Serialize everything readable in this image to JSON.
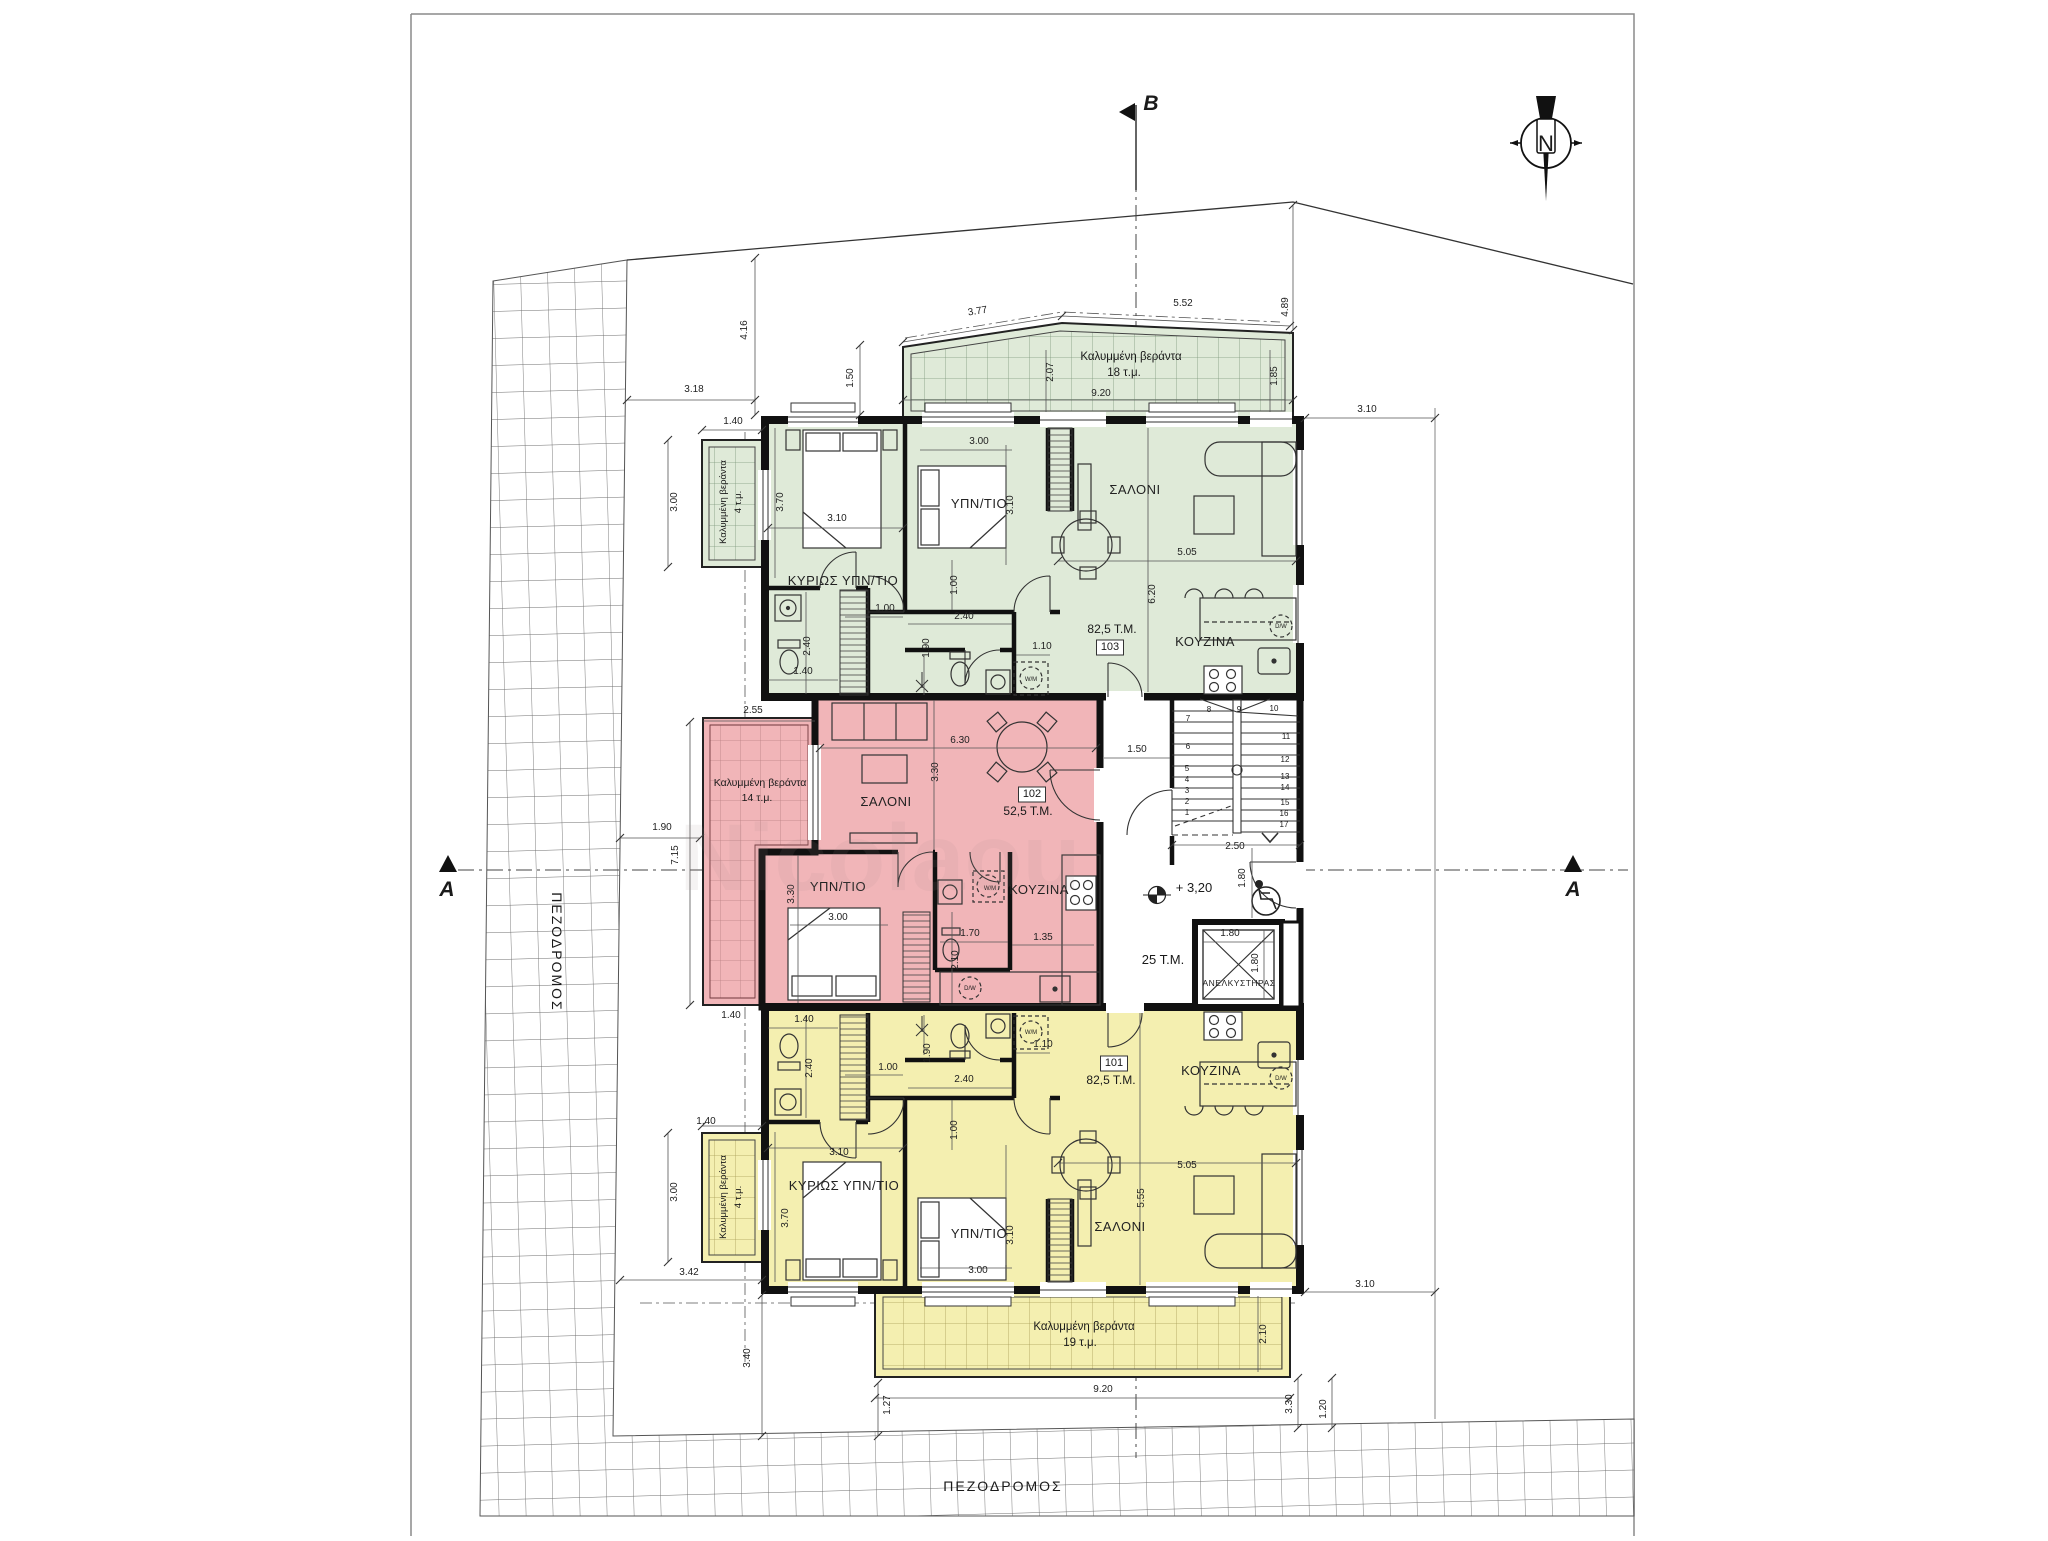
{
  "site": {
    "street_left": "ΠΕΖΟΔΡΟΜΟΣ",
    "street_bottom": "ΠΕΖΟΔΡΟΜΟΣ",
    "section_markers": [
      "A",
      "A",
      "B"
    ],
    "north_label": "N",
    "common_hall_area": "25 T.M.",
    "elevator_label": "ΑΝΕΛΚΥΣΤΗΡΑΣ",
    "level_mark": "+ 3,20",
    "stair_step_count": 17
  },
  "units": [
    {
      "id": "103",
      "area": "82,5 T.M.",
      "fill": "#dfead8",
      "rooms": [
        "ΚΥΡΙΩΣ ΥΠΝ/ΤΙΟ",
        "ΥΠΝ/ΤΙΟ",
        "ΣΑΛΟΝΙ",
        "ΚΟΥΖΙΝΑ"
      ],
      "verandas": [
        "Καλυμμένη βεράντα 18 τ.μ.",
        "Καλυμμένη βεράντα 4 τ.μ."
      ]
    },
    {
      "id": "102",
      "area": "52,5 T.M.",
      "fill": "#f1b5b8",
      "rooms": [
        "ΣΑΛΟΝΙ",
        "ΥΠΝ/ΤΙΟ",
        "ΚΟΥΖΙΝΑ"
      ],
      "verandas": [
        "Καλυμμένη βεράντα 14 τ.μ."
      ]
    },
    {
      "id": "101",
      "area": "82,5 T.M.",
      "fill": "#f4efb0",
      "rooms": [
        "ΚΥΡΙΩΣ ΥΠΝ/ΤΙΟ",
        "ΥΠΝ/ΤΙΟ",
        "ΣΑΛΟΝΙ",
        "ΚΟΥΖΙΝΑ"
      ],
      "verandas": [
        "Καλυμμένη βεράντα 19 τ.μ.",
        "Καλυμμένη βεράντα 4 τ.μ."
      ]
    }
  ],
  "colors": {
    "green": "#dfead8",
    "pink": "#f1b5b8",
    "yellow": "#f4efb0",
    "wall": "#111111"
  },
  "annotations": [
    {
      "t": "B",
      "x": 1151,
      "y": 110,
      "s": 21,
      "k": "section"
    },
    {
      "t": "A",
      "x": 447,
      "y": 896,
      "s": 21,
      "k": "section"
    },
    {
      "t": "A",
      "x": 1573,
      "y": 896,
      "s": 21,
      "k": "section"
    },
    {
      "t": "N",
      "x": 1546,
      "y": 151,
      "s": 22,
      "k": "compass"
    },
    {
      "t": "ΠΕΖΟΔΡΟΜΟΣ",
      "x": 552,
      "y": 952,
      "s": 14,
      "r": 90,
      "k": "street"
    },
    {
      "t": "ΠΕΖΟΔΡΟΜΟΣ",
      "x": 1003,
      "y": 1491,
      "s": 14,
      "k": "street"
    },
    {
      "t": "ΚΥΡΙΩΣ ΥΠΝ/ΤΙΟ",
      "x": 843,
      "y": 585,
      "s": 13,
      "k": "room"
    },
    {
      "t": "ΥΠΝ/ΤΙΟ",
      "x": 979,
      "y": 508,
      "s": 13,
      "k": "room"
    },
    {
      "t": "ΣΑΛΟΝΙ",
      "x": 1135,
      "y": 494,
      "s": 13,
      "k": "room"
    },
    {
      "t": "ΚΟΥΖΙΝΑ",
      "x": 1205,
      "y": 646,
      "s": 13,
      "k": "room"
    },
    {
      "t": "82,5 T.M.",
      "x": 1112,
      "y": 633,
      "s": 12,
      "k": "area"
    },
    {
      "t": "103",
      "x": 1110,
      "y": 650,
      "s": 11,
      "k": "unit",
      "box": 1
    },
    {
      "t": "Καλυμμένη βεράντα",
      "x": 1131,
      "y": 360,
      "s": 11.5,
      "k": "ver"
    },
    {
      "t": "18 τ.μ.",
      "x": 1124,
      "y": 376,
      "s": 11.5,
      "k": "ver"
    },
    {
      "t": "Καλυμμένη βεράντα",
      "x": 726,
      "y": 502,
      "s": 9.5,
      "r": -90,
      "k": "ver"
    },
    {
      "t": "4 τ.μ.",
      "x": 741,
      "y": 502,
      "s": 9.5,
      "r": -90,
      "k": "ver"
    },
    {
      "t": "ΣΑΛΟΝΙ",
      "x": 886,
      "y": 806,
      "s": 13,
      "k": "room"
    },
    {
      "t": "ΥΠΝ/ΤΙΟ",
      "x": 838,
      "y": 891,
      "s": 13,
      "k": "room"
    },
    {
      "t": "ΚΟΥΖΙΝΑ",
      "x": 1039,
      "y": 894,
      "s": 13,
      "k": "room"
    },
    {
      "t": "102",
      "x": 1032,
      "y": 797,
      "s": 11,
      "k": "unit",
      "box": 1
    },
    {
      "t": "52,5 T.M.",
      "x": 1028,
      "y": 815,
      "s": 12,
      "k": "area"
    },
    {
      "t": "Καλυμμένη βεράντα",
      "x": 760,
      "y": 786,
      "s": 10.5,
      "k": "ver"
    },
    {
      "t": "14 τ.μ.",
      "x": 757,
      "y": 801,
      "s": 10.5,
      "k": "ver"
    },
    {
      "t": "ΚΥΡΙΩΣ ΥΠΝ/ΤΙΟ",
      "x": 844,
      "y": 1190,
      "s": 13,
      "k": "room"
    },
    {
      "t": "ΥΠΝ/ΤΙΟ",
      "x": 979,
      "y": 1238,
      "s": 13,
      "k": "room"
    },
    {
      "t": "ΣΑΛΟΝΙ",
      "x": 1120,
      "y": 1231,
      "s": 13,
      "k": "room"
    },
    {
      "t": "ΚΟΥΖΙΝΑ",
      "x": 1211,
      "y": 1075,
      "s": 13,
      "k": "room"
    },
    {
      "t": "101",
      "x": 1114,
      "y": 1066,
      "s": 11,
      "k": "unit",
      "box": 1
    },
    {
      "t": "82,5 T.M.",
      "x": 1111,
      "y": 1084,
      "s": 12,
      "k": "area"
    },
    {
      "t": "Καλυμμένη βεράντα",
      "x": 1084,
      "y": 1330,
      "s": 11.5,
      "k": "ver"
    },
    {
      "t": "19 τ.μ.",
      "x": 1080,
      "y": 1346,
      "s": 11.5,
      "k": "ver"
    },
    {
      "t": "Καλυμμένη βεράντα",
      "x": 726,
      "y": 1197,
      "s": 9.5,
      "r": -90,
      "k": "ver"
    },
    {
      "t": "4 τ.μ.",
      "x": 741,
      "y": 1197,
      "s": 9.5,
      "r": -90,
      "k": "ver"
    },
    {
      "t": "ΑΝΕΛΚΥΣΤΗΡΑΣ",
      "x": 1239,
      "y": 986,
      "s": 8.5,
      "k": "room"
    },
    {
      "t": "25 T.M.",
      "x": 1163,
      "y": 964,
      "s": 13,
      "k": "area"
    },
    {
      "t": "+ 3,20",
      "x": 1194,
      "y": 892,
      "s": 13,
      "k": "level"
    },
    {
      "t": "4.16",
      "x": 747,
      "y": 330,
      "r": -90,
      "k": "dim"
    },
    {
      "t": "3.18",
      "x": 694,
      "y": 392,
      "k": "dim"
    },
    {
      "t": "1.50",
      "x": 853,
      "y": 378,
      "r": -90,
      "k": "dim"
    },
    {
      "t": "1.40",
      "x": 733,
      "y": 424,
      "k": "dim"
    },
    {
      "t": "3.77",
      "x": 978,
      "y": 314,
      "r": -9,
      "k": "dim"
    },
    {
      "t": "5.52",
      "x": 1183,
      "y": 306,
      "k": "dim"
    },
    {
      "t": "4.89",
      "x": 1288,
      "y": 307,
      "r": -90,
      "k": "dim"
    },
    {
      "t": "2.07",
      "x": 1053,
      "y": 372,
      "r": -90,
      "k": "dim"
    },
    {
      "t": "9.20",
      "x": 1101,
      "y": 396,
      "k": "dim"
    },
    {
      "t": "1.85",
      "x": 1277,
      "y": 376,
      "r": -90,
      "k": "dim"
    },
    {
      "t": "3.10",
      "x": 1367,
      "y": 412,
      "k": "dim"
    },
    {
      "t": "3.70",
      "x": 783,
      "y": 502,
      "r": -90,
      "k": "dim"
    },
    {
      "t": "3.10",
      "x": 837,
      "y": 521,
      "k": "dim"
    },
    {
      "t": "3.00",
      "x": 979,
      "y": 444,
      "k": "dim"
    },
    {
      "t": "3.10",
      "x": 1013,
      "y": 505,
      "r": -90,
      "k": "dim"
    },
    {
      "t": "5.05",
      "x": 1187,
      "y": 555,
      "k": "dim"
    },
    {
      "t": "6.20",
      "x": 1155,
      "y": 594,
      "r": -90,
      "k": "dim"
    },
    {
      "t": "1.00",
      "x": 957,
      "y": 585,
      "r": -90,
      "k": "dim"
    },
    {
      "t": "1.00",
      "x": 885,
      "y": 611,
      "k": "dim"
    },
    {
      "t": "2.40",
      "x": 964,
      "y": 619,
      "k": "dim"
    },
    {
      "t": "1.90",
      "x": 929,
      "y": 648,
      "r": -90,
      "k": "dim"
    },
    {
      "t": "1.10",
      "x": 1042,
      "y": 649,
      "k": "dim"
    },
    {
      "t": "2.40",
      "x": 810,
      "y": 646,
      "r": -90,
      "k": "dim"
    },
    {
      "t": "1.40",
      "x": 803,
      "y": 674,
      "k": "dim"
    },
    {
      "t": "3.00",
      "x": 677,
      "y": 502,
      "r": -90,
      "k": "dim"
    },
    {
      "t": "2.55",
      "x": 753,
      "y": 713,
      "k": "dim"
    },
    {
      "t": "6.30",
      "x": 960,
      "y": 743,
      "k": "dim"
    },
    {
      "t": "3.30",
      "x": 938,
      "y": 772,
      "r": -90,
      "k": "dim"
    },
    {
      "t": "3.30",
      "x": 794,
      "y": 894,
      "r": -90,
      "k": "dim"
    },
    {
      "t": "3.00",
      "x": 838,
      "y": 920,
      "k": "dim"
    },
    {
      "t": "1.70",
      "x": 970,
      "y": 936,
      "k": "dim"
    },
    {
      "t": "2.10",
      "x": 958,
      "y": 960,
      "r": -90,
      "k": "dim"
    },
    {
      "t": "1.35",
      "x": 1043,
      "y": 940,
      "k": "dim"
    },
    {
      "t": "1.50",
      "x": 1137,
      "y": 752,
      "k": "dim"
    },
    {
      "t": "1.90",
      "x": 662,
      "y": 830,
      "k": "dim"
    },
    {
      "t": "7.15",
      "x": 678,
      "y": 855,
      "r": -90,
      "k": "dim"
    },
    {
      "t": "1.40",
      "x": 731,
      "y": 1018,
      "k": "dim"
    },
    {
      "t": "2.50",
      "x": 1235,
      "y": 849,
      "k": "dim"
    },
    {
      "t": "1.80",
      "x": 1245,
      "y": 878,
      "r": -90,
      "k": "dim"
    },
    {
      "t": "1.80",
      "x": 1230,
      "y": 936,
      "k": "dim"
    },
    {
      "t": "1.80",
      "x": 1258,
      "y": 963,
      "r": -90,
      "k": "dim"
    },
    {
      "t": "1.40",
      "x": 804,
      "y": 1022,
      "k": "dim"
    },
    {
      "t": "2.40",
      "x": 812,
      "y": 1068,
      "r": -90,
      "k": "dim"
    },
    {
      "t": "1.00",
      "x": 888,
      "y": 1070,
      "k": "dim"
    },
    {
      "t": "1.90",
      "x": 930,
      "y": 1053,
      "r": -90,
      "k": "dim"
    },
    {
      "t": "2.40",
      "x": 964,
      "y": 1082,
      "k": "dim"
    },
    {
      "t": "1.10",
      "x": 1043,
      "y": 1047,
      "k": "dim"
    },
    {
      "t": "1.00",
      "x": 957,
      "y": 1130,
      "r": -90,
      "k": "dim"
    },
    {
      "t": "3.10",
      "x": 839,
      "y": 1155,
      "k": "dim"
    },
    {
      "t": "3.70",
      "x": 788,
      "y": 1218,
      "r": -90,
      "k": "dim"
    },
    {
      "t": "3.00",
      "x": 978,
      "y": 1273,
      "k": "dim"
    },
    {
      "t": "3.10",
      "x": 1013,
      "y": 1235,
      "r": -90,
      "k": "dim"
    },
    {
      "t": "5.55",
      "x": 1144,
      "y": 1198,
      "r": -90,
      "k": "dim"
    },
    {
      "t": "5.05",
      "x": 1187,
      "y": 1168,
      "k": "dim"
    },
    {
      "t": "3.00",
      "x": 677,
      "y": 1192,
      "r": -90,
      "k": "dim"
    },
    {
      "t": "1.40",
      "x": 706,
      "y": 1124,
      "k": "dim"
    },
    {
      "t": "3.42",
      "x": 689,
      "y": 1275,
      "k": "dim"
    },
    {
      "t": "3.40",
      "x": 750,
      "y": 1358,
      "r": -90,
      "k": "dim"
    },
    {
      "t": "2.10",
      "x": 1266,
      "y": 1334,
      "r": -90,
      "k": "dim"
    },
    {
      "t": "9.20",
      "x": 1103,
      "y": 1392,
      "k": "dim"
    },
    {
      "t": "1.27",
      "x": 890,
      "y": 1405,
      "r": -90,
      "k": "dim"
    },
    {
      "t": "3.30",
      "x": 1292,
      "y": 1404,
      "r": -90,
      "k": "dim"
    },
    {
      "t": "1.20",
      "x": 1326,
      "y": 1409,
      "r": -90,
      "k": "dim"
    },
    {
      "t": "3.10",
      "x": 1365,
      "y": 1287,
      "k": "dim"
    },
    {
      "t": "W/M",
      "x": 1031,
      "y": 681,
      "s": 6,
      "k": "fixture"
    },
    {
      "t": "D/W",
      "x": 1281,
      "y": 628,
      "s": 6,
      "k": "fixture"
    },
    {
      "t": "W/M",
      "x": 990,
      "y": 890,
      "s": 6,
      "k": "fixture"
    },
    {
      "t": "D/W",
      "x": 970,
      "y": 990,
      "s": 6,
      "k": "fixture"
    },
    {
      "t": "W/M",
      "x": 1031,
      "y": 1034,
      "s": 6,
      "k": "fixture"
    },
    {
      "t": "D/W",
      "x": 1281,
      "y": 1080,
      "s": 6,
      "k": "fixture"
    },
    {
      "t": "1",
      "x": 1187,
      "y": 815,
      "s": 8,
      "k": "step"
    },
    {
      "t": "2",
      "x": 1187,
      "y": 804,
      "s": 8,
      "k": "step"
    },
    {
      "t": "3",
      "x": 1187,
      "y": 793,
      "s": 8,
      "k": "step"
    },
    {
      "t": "4",
      "x": 1187,
      "y": 782,
      "s": 8,
      "k": "step"
    },
    {
      "t": "5",
      "x": 1187,
      "y": 771,
      "s": 8,
      "k": "step"
    },
    {
      "t": "6",
      "x": 1188,
      "y": 749,
      "s": 8,
      "k": "step"
    },
    {
      "t": "7",
      "x": 1188,
      "y": 721,
      "s": 8,
      "k": "step"
    },
    {
      "t": "8",
      "x": 1209,
      "y": 712,
      "s": 8,
      "k": "step"
    },
    {
      "t": "9",
      "x": 1239,
      "y": 712,
      "s": 8,
      "k": "step"
    },
    {
      "t": "10",
      "x": 1274,
      "y": 711,
      "s": 8,
      "k": "step"
    },
    {
      "t": "11",
      "x": 1286,
      "y": 739,
      "s": 8,
      "k": "step"
    },
    {
      "t": "12",
      "x": 1285,
      "y": 762,
      "s": 8,
      "k": "step"
    },
    {
      "t": "13",
      "x": 1285,
      "y": 779,
      "s": 8,
      "k": "step"
    },
    {
      "t": "14",
      "x": 1285,
      "y": 790,
      "s": 8,
      "k": "step"
    },
    {
      "t": "15",
      "x": 1285,
      "y": 805,
      "s": 8,
      "k": "step"
    },
    {
      "t": "16",
      "x": 1284,
      "y": 816,
      "s": 8,
      "k": "step"
    },
    {
      "t": "17",
      "x": 1284,
      "y": 827,
      "s": 8,
      "k": "step"
    },
    {
      "t": "Nicolaou",
      "x": 880,
      "y": 890,
      "s": 95,
      "k": "wm"
    }
  ]
}
